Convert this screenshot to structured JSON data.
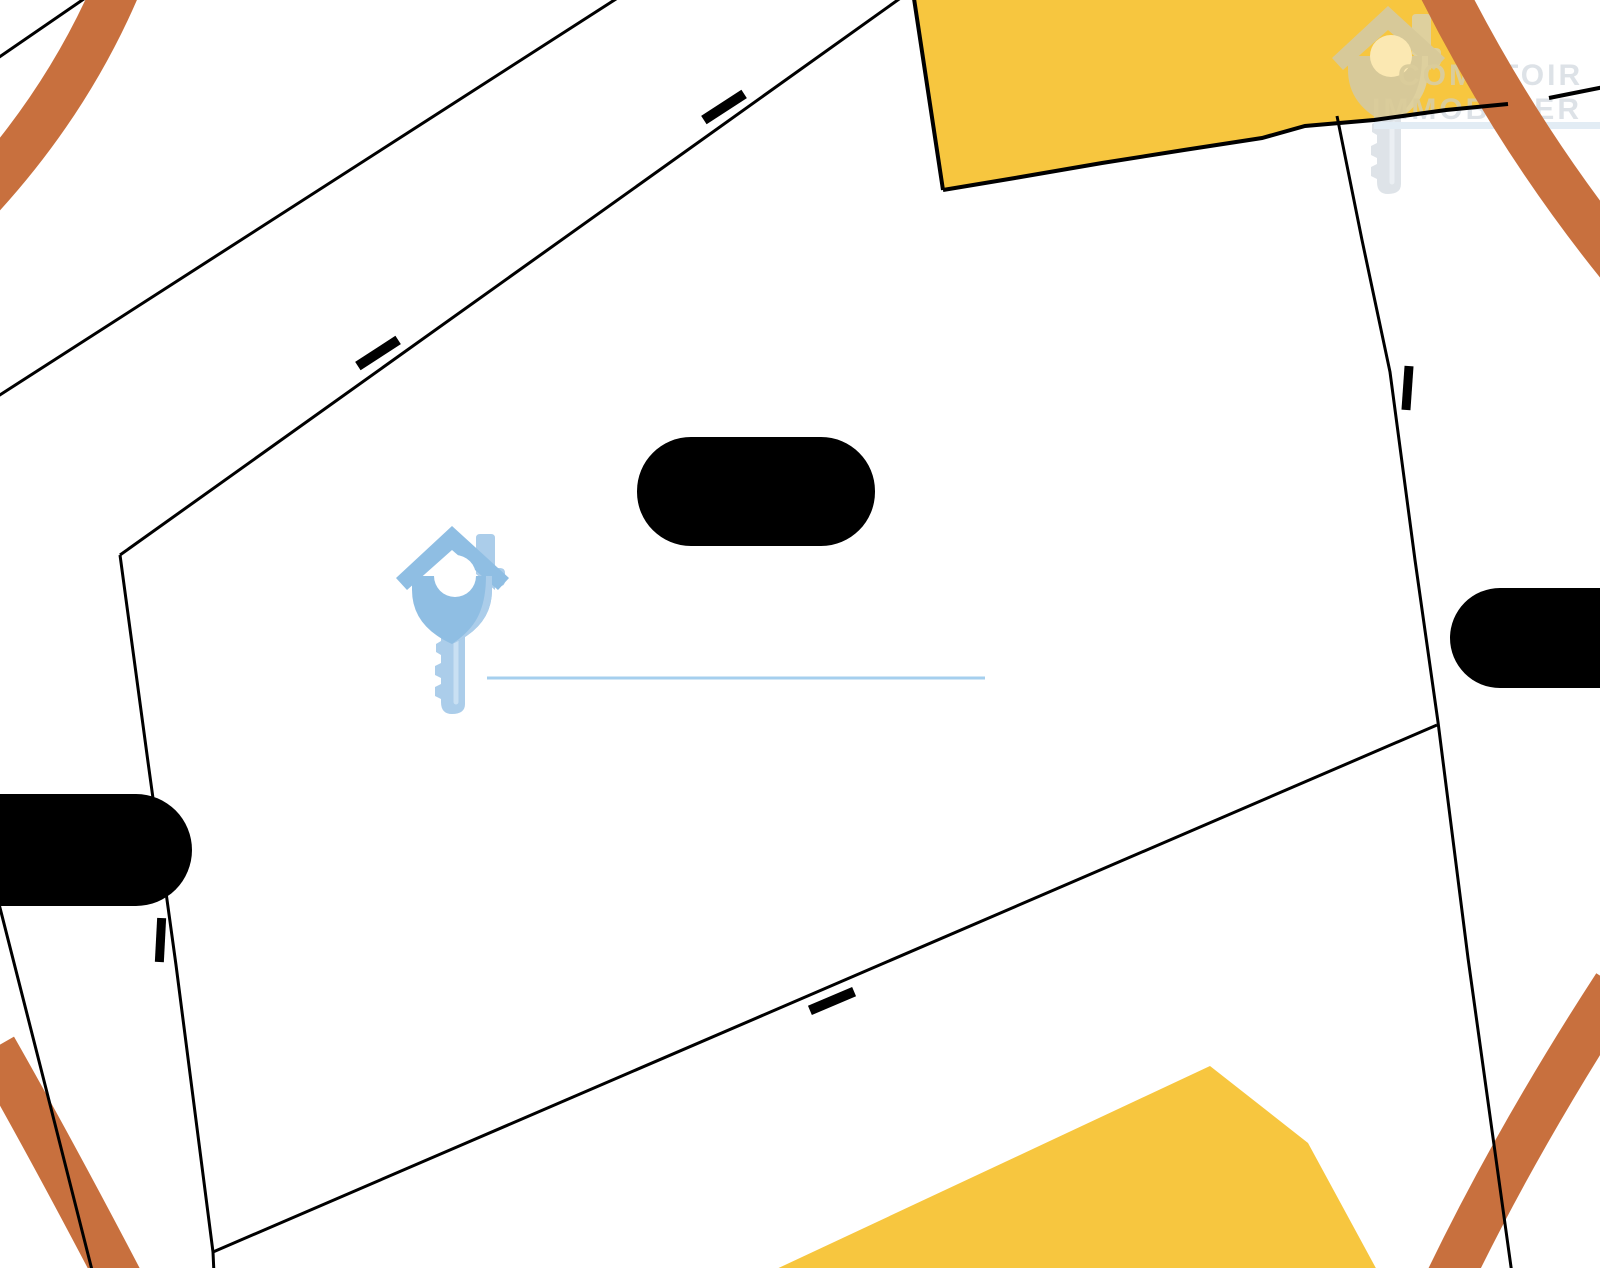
{
  "watermark": {
    "line1": "COMPTOIR",
    "line2": "IMMOBILIER"
  },
  "icons": {
    "marker": "house-key-icon",
    "watermark_logo": "house-key-icon"
  },
  "colors": {
    "background": "#FFFFFF",
    "parcel_line": "#000000",
    "road": "#C8703E",
    "building": "#F7C63F",
    "redaction": "#000000",
    "marker_blue": "#8FBEE3",
    "marker_blue_light": "#ABCDEA",
    "marker_stripe": "#C9E0F3",
    "marker_hole": "#FFFFFF",
    "brand_underline": "#A5CFEE",
    "watermark_gray": "#C2CCD5",
    "watermark_gray_light": "#CED7DE",
    "watermark_shaft": "#C9D2DA",
    "watermark_stripe": "#DEE6EC",
    "watermark_underline": "#CFE0EE",
    "watermark_text": "#C8D0D8"
  }
}
